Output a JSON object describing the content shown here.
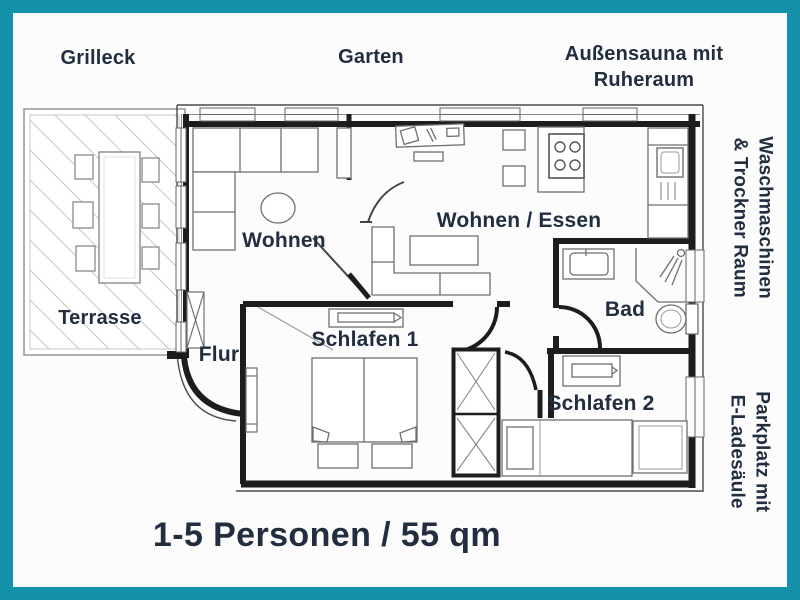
{
  "title": "Apartment floor plan flyer",
  "colors": {
    "border_teal": "#1492ab",
    "ink_navy": "#222e40",
    "background": "#fcfcfc",
    "wall": "#1d1d1f",
    "furniture_line": "#6f6f6f",
    "terrace_line": "#9a9a9a"
  },
  "outdoor": {
    "grill": "Grilleck",
    "garden": "Garten",
    "sauna": "Außensauna mit\nRuheraum",
    "terrace": "Terrasse"
  },
  "rooms": {
    "living": "Wohnen",
    "living_dining": "Wohnen / Essen",
    "bath": "Bad",
    "hall": "Flur",
    "bedroom1": "Schlafen 1",
    "bedroom2": "Schlafen 2"
  },
  "side": {
    "laundry": "Waschmaschinen\n& Trockner Raum",
    "parking": "Parkplatz mit\nE-Ladesäule"
  },
  "caption": "1-5 Personen / 55 qm"
}
